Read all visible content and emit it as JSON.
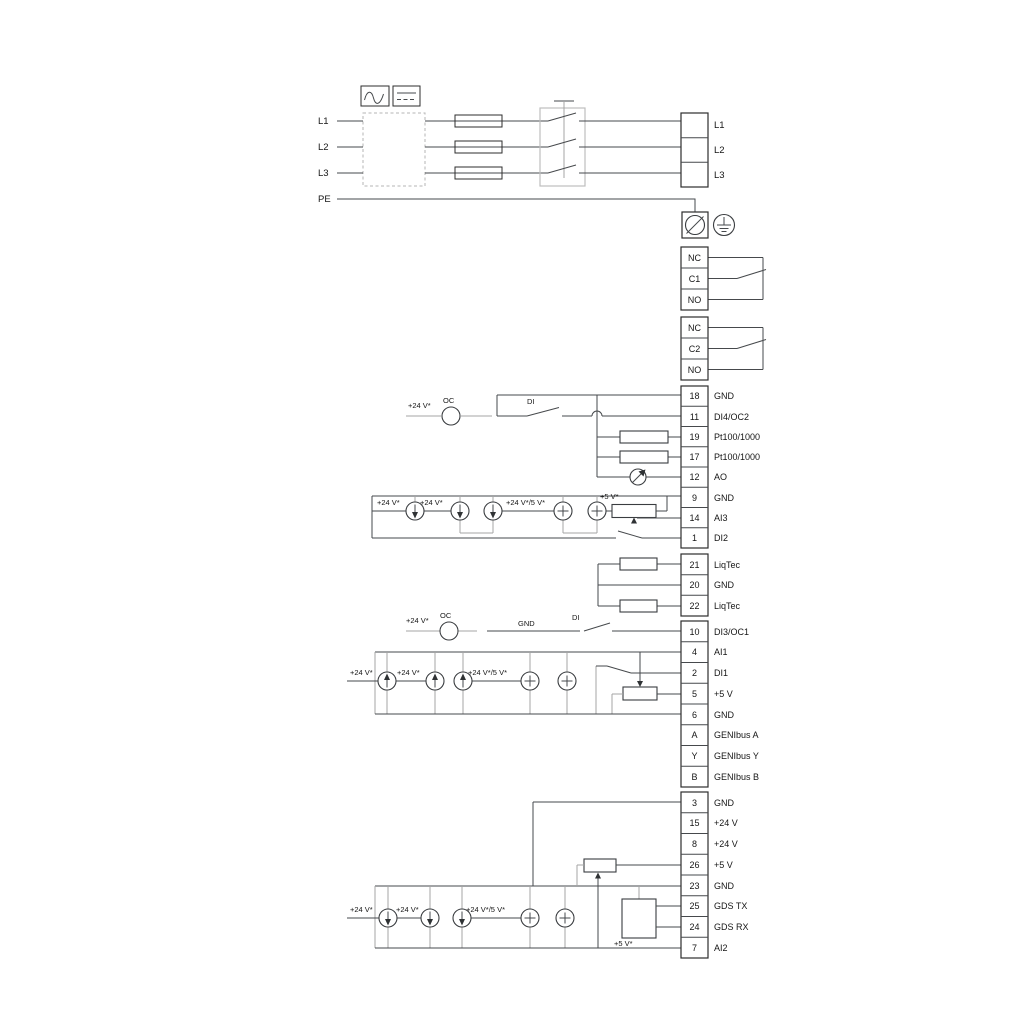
{
  "meta": {
    "type": "wiring-diagram",
    "colors": {
      "wire_dark": "#46494c",
      "wire_gray": "#a4a4a4",
      "text": "#161616",
      "background": "#ffffff"
    },
    "icons": {
      "ac": "ac-waveform-icon",
      "dc": "dc-line-icon",
      "fuse": "fuse-symbol",
      "switch": "three-pole-switch",
      "pe": "pe-screw-terminal-icon",
      "earth": "protective-earth-icon",
      "meter": "analog-output-meter-icon",
      "current": "current-source-icon",
      "voltage": "voltage-source-icon"
    }
  },
  "power": {
    "inputs": [
      "L1",
      "L2",
      "L3",
      "PE"
    ],
    "outputs": [
      "L1",
      "L2",
      "L3"
    ]
  },
  "relays": {
    "relay1": [
      "NC",
      "C1",
      "NO"
    ],
    "relay2": [
      "NC",
      "C2",
      "NO"
    ]
  },
  "terminals": {
    "g1": [
      {
        "num": "18",
        "label": "GND"
      },
      {
        "num": "11",
        "label": "DI4/OC2"
      },
      {
        "num": "19",
        "label": "Pt100/1000"
      },
      {
        "num": "17",
        "label": "Pt100/1000"
      },
      {
        "num": "12",
        "label": "AO"
      },
      {
        "num": "9",
        "label": "GND"
      },
      {
        "num": "14",
        "label": "AI3"
      },
      {
        "num": "1",
        "label": "DI2"
      }
    ],
    "g2": [
      {
        "num": "21",
        "label": "LiqTec"
      },
      {
        "num": "20",
        "label": "GND"
      },
      {
        "num": "22",
        "label": "LiqTec"
      }
    ],
    "g3": [
      {
        "num": "10",
        "label": "DI3/OC1"
      },
      {
        "num": "4",
        "label": "AI1"
      },
      {
        "num": "2",
        "label": "DI1"
      },
      {
        "num": "5",
        "label": "+5 V"
      },
      {
        "num": "6",
        "label": "GND"
      },
      {
        "num": "A",
        "label": "GENIbus A"
      },
      {
        "num": "Y",
        "label": "GENIbus Y"
      },
      {
        "num": "B",
        "label": "GENIbus B"
      }
    ],
    "g4": [
      {
        "num": "3",
        "label": "GND"
      },
      {
        "num": "15",
        "label": "+24 V"
      },
      {
        "num": "8",
        "label": "+24 V"
      },
      {
        "num": "26",
        "label": "+5 V"
      },
      {
        "num": "23",
        "label": "GND"
      },
      {
        "num": "25",
        "label": "GDS TX"
      },
      {
        "num": "24",
        "label": "GDS RX"
      },
      {
        "num": "7",
        "label": "AI2"
      }
    ]
  },
  "wire_labels": {
    "row11": {
      "v24": "+24 V*",
      "oc": "OC",
      "di": "DI"
    },
    "row10": {
      "v24": "+24 V*",
      "oc": "OC",
      "gnd": "GND",
      "di": "DI"
    },
    "ai3": {
      "v24a": "+24 V*",
      "v24b": "+24 V*",
      "v245": "+24 V*/5 V*",
      "v5": "+5 V*"
    },
    "ai1": {
      "v24a": "+24 V*",
      "v24b": "+24 V*",
      "v245": "+24 V*/5 V*"
    },
    "ai2": {
      "v24a": "+24 V*",
      "v24b": "+24 V*",
      "v245": "+24 V*/5 V*",
      "v5": "+5 V*"
    }
  }
}
